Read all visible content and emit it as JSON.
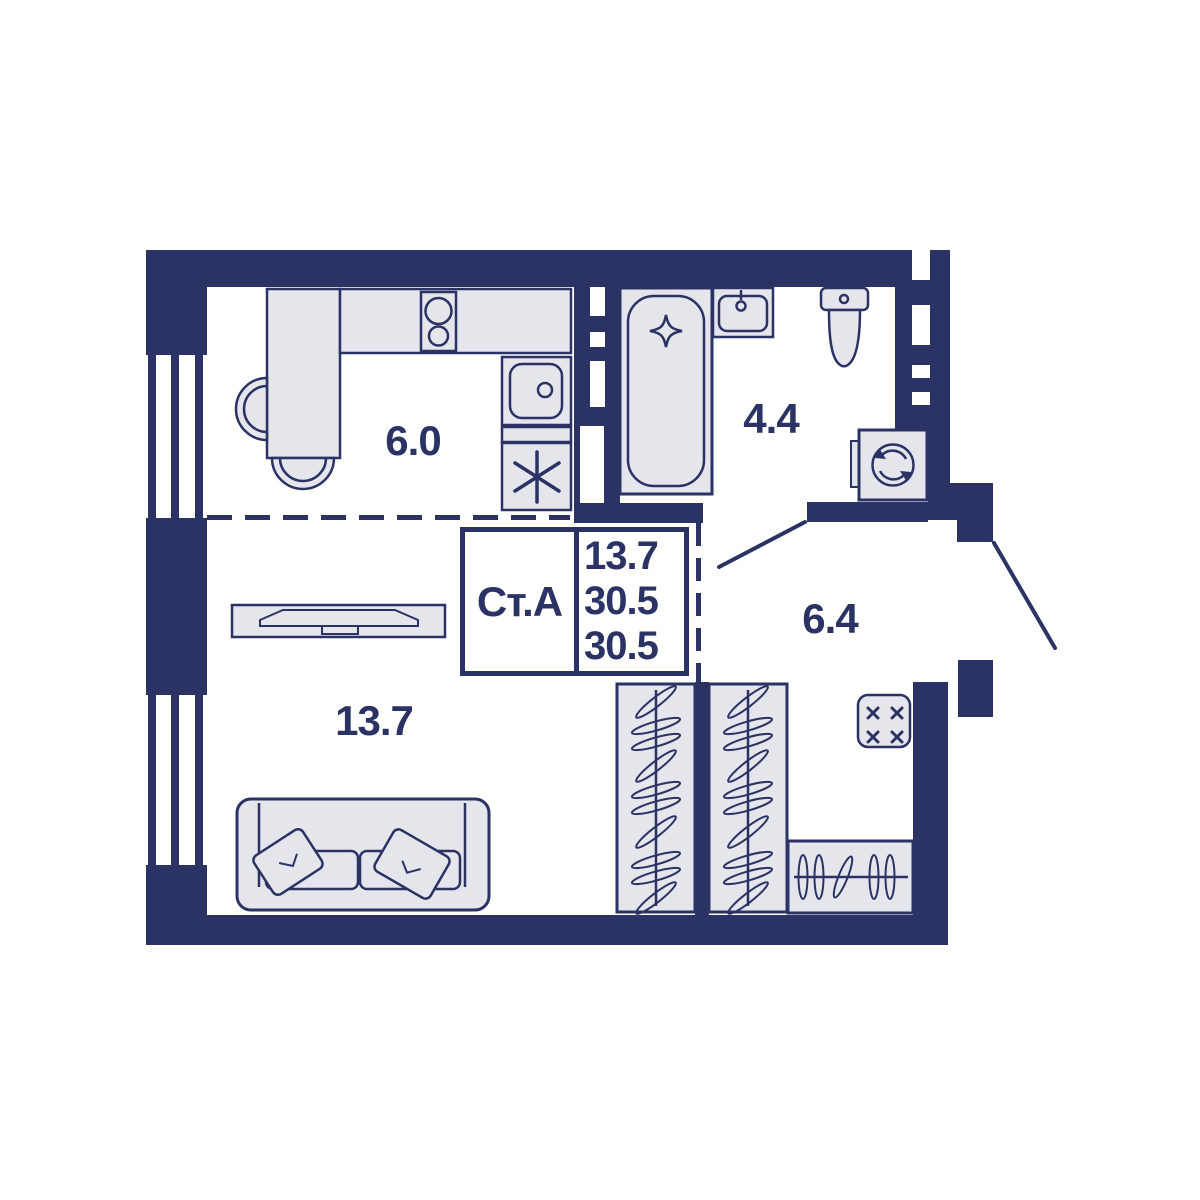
{
  "title": "studio-apartment-floor-plan",
  "colors": {
    "wall": "#2a3364",
    "furniture_fill": "#e5e5ec",
    "outline": "#2a3364",
    "background": "#ffffff"
  },
  "unit_card": {
    "unit": "Ст.А",
    "area_living": "13.7",
    "area_total": "30.5",
    "area_total_reduced": "30.5"
  },
  "rooms": {
    "kitchen": {
      "area": "6.0"
    },
    "bathroom": {
      "area": "4.4"
    },
    "hallway": {
      "area": "6.4"
    },
    "living": {
      "area": "13.7"
    }
  },
  "fixtures": [
    "window",
    "window",
    "dining-table",
    "chair",
    "chair",
    "kitchen-counter",
    "stove-two-burner",
    "kitchen-sink",
    "refrigerator-asterisk",
    "bathtub",
    "washbasin",
    "toilet",
    "washing-machine",
    "wardrobe-tall",
    "wardrobe-tall",
    "wardrobe-low",
    "electrical-panel",
    "tv-stand",
    "sofa",
    "bathroom-door",
    "entrance-door"
  ]
}
